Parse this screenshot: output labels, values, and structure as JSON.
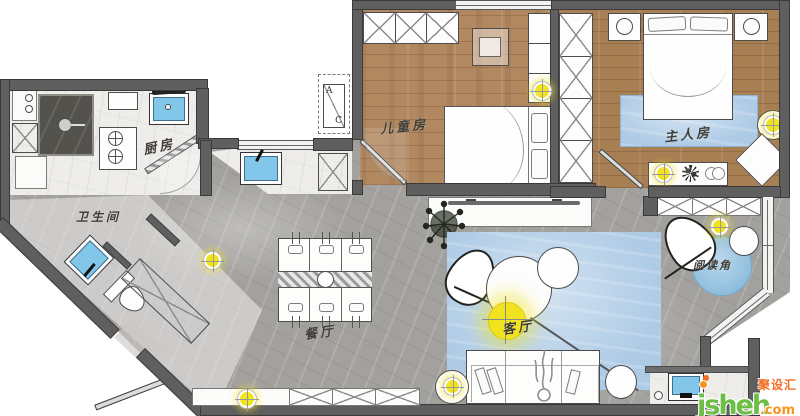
{
  "meta": {
    "type": "apartment-floor-plan"
  },
  "rooms": {
    "kitchen": {
      "label": "厨房"
    },
    "bathroom": {
      "label": "卫生间"
    },
    "kids": {
      "label": "儿童房"
    },
    "master": {
      "label": "主人房"
    },
    "dining": {
      "label": "餐厅"
    },
    "living": {
      "label": "客厅"
    },
    "reading": {
      "label": "阅读角"
    }
  },
  "ac_unit": {
    "top": "A",
    "bottom": "C"
  },
  "watermark": {
    "brand": "jsheh",
    "suffix": ".com",
    "cn": "聚设汇"
  },
  "palette": {
    "wall": "#5f5f5f",
    "wood": "#b18860",
    "marble_gray": "#a3a19e",
    "marble_white": "#eeedea",
    "rug_blue": "#aecbe6",
    "sink_blue": "#82c7ea",
    "light_yellow": "#f2e320",
    "brand_green": "#6cbe45",
    "brand_orange": "#f7941e"
  }
}
